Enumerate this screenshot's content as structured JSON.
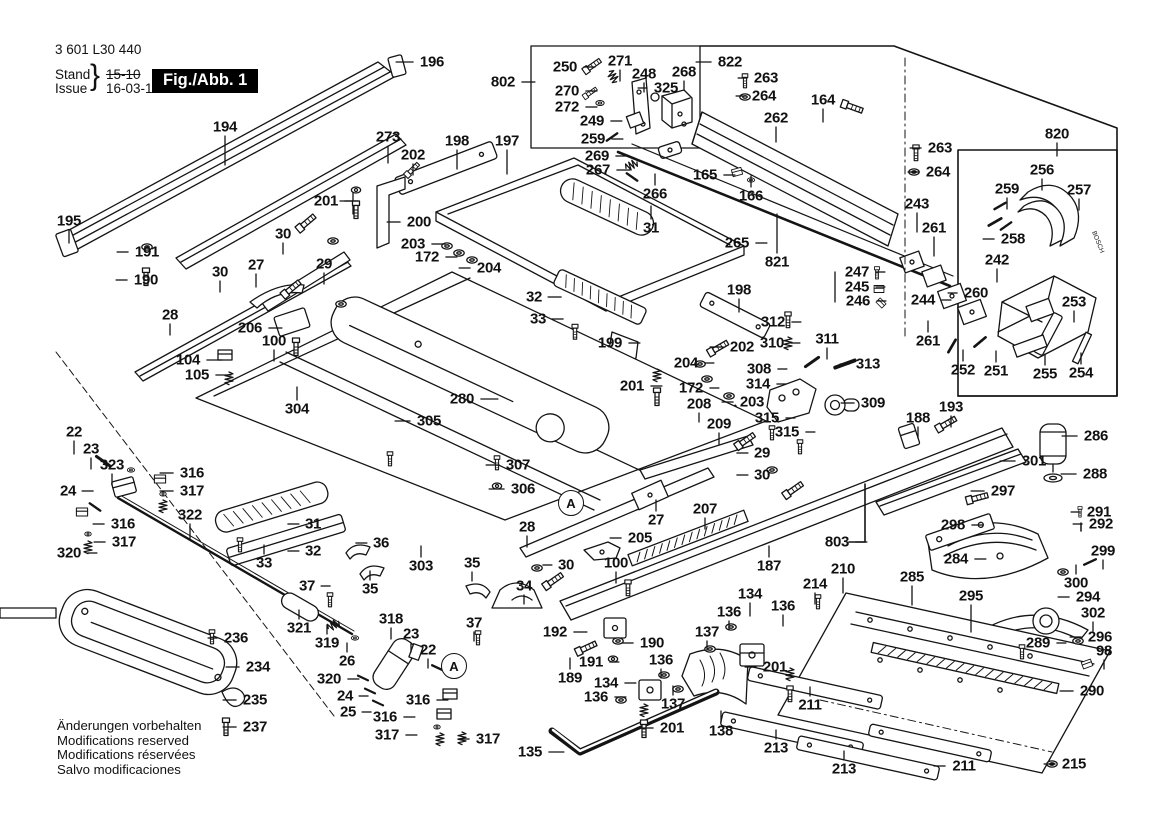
{
  "header": {
    "part_number": "3 601 L30 440",
    "stand_label": "Stand",
    "issue_label": "Issue",
    "brace": "}",
    "old_date": "15-10",
    "new_date": "16-03-10",
    "fig_label": "Fig./Abb. 1"
  },
  "footer": {
    "lines": [
      "Änderungen vorbehalten",
      "Modifications reserved",
      "Modifications réservées",
      "Salvo modificaciones"
    ]
  },
  "brand_text": "BOSCH",
  "colors": {
    "ink": "#141414",
    "badge_bg": "#000000",
    "badge_text": "#ffffff",
    "bg": "#ffffff"
  },
  "circled_refs": [
    {
      "label": "A",
      "x": 571,
      "y": 503
    },
    {
      "label": "A",
      "x": 454,
      "y": 666
    }
  ],
  "part_labels": [
    {
      "t": "194",
      "x": 225,
      "y": 127,
      "d": "d",
      "len": 30
    },
    {
      "t": "273",
      "x": 388,
      "y": 137,
      "d": "d",
      "len": 18
    },
    {
      "t": "196",
      "x": 432,
      "y": 62,
      "d": "l",
      "len": 18
    },
    {
      "t": "202",
      "x": 413,
      "y": 155,
      "d": "d",
      "len": 12
    },
    {
      "t": "198",
      "x": 457,
      "y": 141,
      "d": "d",
      "len": 20
    },
    {
      "t": "197",
      "x": 507,
      "y": 141,
      "d": "d",
      "len": 25
    },
    {
      "t": "201",
      "x": 326,
      "y": 201,
      "d": "r",
      "len": 14
    },
    {
      "t": "200",
      "x": 419,
      "y": 222,
      "d": "l",
      "len": 14
    },
    {
      "t": "30",
      "x": 283,
      "y": 234,
      "d": "d",
      "len": 12
    },
    {
      "t": "27",
      "x": 256,
      "y": 265,
      "d": "d",
      "len": 14
    },
    {
      "t": "29",
      "x": 324,
      "y": 264,
      "d": "d",
      "len": 12
    },
    {
      "t": "203",
      "x": 413,
      "y": 244,
      "d": "r",
      "len": 14
    },
    {
      "t": "172",
      "x": 427,
      "y": 257,
      "d": "r",
      "len": 12
    },
    {
      "t": "204",
      "x": 489,
      "y": 268,
      "d": "l",
      "len": 12
    },
    {
      "t": "195",
      "x": 69,
      "y": 221,
      "d": "d",
      "len": 14
    },
    {
      "t": "191",
      "x": 147,
      "y": 252,
      "d": "l",
      "len": 12
    },
    {
      "t": "190",
      "x": 146,
      "y": 280,
      "d": "l",
      "len": 12
    },
    {
      "t": "30",
      "x": 220,
      "y": 272,
      "d": "d",
      "len": 12
    },
    {
      "t": "28",
      "x": 170,
      "y": 315,
      "d": "d",
      "len": 12
    },
    {
      "t": "206",
      "x": 250,
      "y": 328,
      "d": "r",
      "len": 14
    },
    {
      "t": "100",
      "x": 274,
      "y": 341,
      "d": "d",
      "len": 12
    },
    {
      "t": "104",
      "x": 188,
      "y": 360,
      "d": "r",
      "len": 16
    },
    {
      "t": "105",
      "x": 197,
      "y": 375,
      "d": "r",
      "len": 16
    },
    {
      "t": "304",
      "x": 297,
      "y": 409,
      "d": "u",
      "len": 14
    },
    {
      "t": "305",
      "x": 429,
      "y": 421,
      "d": "l",
      "len": 16
    },
    {
      "t": "280",
      "x": 462,
      "y": 399,
      "d": "r",
      "len": 18
    },
    {
      "t": "32",
      "x": 534,
      "y": 297,
      "d": "r",
      "len": 14
    },
    {
      "t": "33",
      "x": 538,
      "y": 319,
      "d": "r",
      "len": 12
    },
    {
      "t": "31",
      "x": 651,
      "y": 228,
      "d": "u",
      "len": 14
    },
    {
      "t": "199",
      "x": 610,
      "y": 343,
      "d": "r",
      "len": 12
    },
    {
      "t": "198",
      "x": 739,
      "y": 290,
      "d": "d",
      "len": 14
    },
    {
      "t": "202",
      "x": 742,
      "y": 347,
      "d": "l",
      "len": 14
    },
    {
      "t": "204",
      "x": 686,
      "y": 363,
      "d": "r",
      "len": 10
    },
    {
      "t": "172",
      "x": 691,
      "y": 388,
      "d": "r",
      "len": 10
    },
    {
      "t": "203",
      "x": 752,
      "y": 402,
      "d": "l",
      "len": 12
    },
    {
      "t": "201",
      "x": 632,
      "y": 386,
      "d": "r",
      "len": 12
    },
    {
      "t": "208",
      "x": 699,
      "y": 404,
      "d": "d",
      "len": 10
    },
    {
      "t": "209",
      "x": 719,
      "y": 424,
      "d": "d",
      "len": 12
    },
    {
      "t": "307",
      "x": 518,
      "y": 465,
      "d": "l",
      "len": 14
    },
    {
      "t": "306",
      "x": 523,
      "y": 489,
      "d": "l",
      "len": 16
    },
    {
      "t": "265",
      "x": 737,
      "y": 243,
      "d": "r",
      "len": 12
    },
    {
      "t": "821",
      "x": 777,
      "y": 262,
      "d": "u",
      "len": 40
    },
    {
      "t": "266",
      "x": 655,
      "y": 194,
      "d": "u",
      "len": 12
    },
    {
      "t": "267",
      "x": 598,
      "y": 170,
      "d": "r",
      "len": 14
    },
    {
      "t": "269",
      "x": 597,
      "y": 156,
      "d": "r",
      "len": 14
    },
    {
      "t": "259",
      "x": 593,
      "y": 139,
      "d": "r",
      "len": 12
    },
    {
      "t": "249",
      "x": 592,
      "y": 121,
      "d": "r",
      "len": 12
    },
    {
      "t": "272",
      "x": 567,
      "y": 107,
      "d": "r",
      "len": 12
    },
    {
      "t": "270",
      "x": 567,
      "y": 91,
      "d": "r",
      "len": 12
    },
    {
      "t": "250",
      "x": 565,
      "y": 67,
      "d": "r",
      "len": 12
    },
    {
      "t": "271",
      "x": 620,
      "y": 61,
      "d": "d",
      "len": 12
    },
    {
      "t": "248",
      "x": 644,
      "y": 74,
      "d": "d",
      "len": 10
    },
    {
      "t": "268",
      "x": 684,
      "y": 72,
      "d": "d",
      "len": 10
    },
    {
      "t": "325",
      "x": 666,
      "y": 88,
      "d": "l",
      "len": 10
    },
    {
      "t": "802",
      "x": 503,
      "y": 82,
      "d": "r",
      "len": 14
    },
    {
      "t": "822",
      "x": 730,
      "y": 62,
      "d": "l",
      "len": 16
    },
    {
      "t": "263",
      "x": 766,
      "y": 78,
      "d": "l",
      "len": 10
    },
    {
      "t": "264",
      "x": 764,
      "y": 96,
      "d": "l",
      "len": 10
    },
    {
      "t": "164",
      "x": 823,
      "y": 100,
      "d": "d",
      "len": 14
    },
    {
      "t": "262",
      "x": 776,
      "y": 118,
      "d": "d",
      "len": 16
    },
    {
      "t": "165",
      "x": 705,
      "y": 175,
      "d": "r",
      "len": 12
    },
    {
      "t": "166",
      "x": 751,
      "y": 196,
      "d": "u",
      "len": 12
    },
    {
      "t": "263",
      "x": 940,
      "y": 148,
      "d": "l",
      "len": 12
    },
    {
      "t": "264",
      "x": 938,
      "y": 172,
      "d": "l",
      "len": 12
    },
    {
      "t": "243",
      "x": 917,
      "y": 204,
      "d": "d",
      "len": 20
    },
    {
      "t": "261",
      "x": 934,
      "y": 228,
      "d": "d",
      "len": 20
    },
    {
      "t": "820",
      "x": 1057,
      "y": 134,
      "d": "d",
      "len": 14
    },
    {
      "t": "256",
      "x": 1042,
      "y": 170,
      "d": "d",
      "len": 12
    },
    {
      "t": "259",
      "x": 1007,
      "y": 189,
      "d": "d",
      "len": 12
    },
    {
      "t": "257",
      "x": 1079,
      "y": 190,
      "d": "d",
      "len": 12
    },
    {
      "t": "258",
      "x": 1013,
      "y": 239,
      "d": "l",
      "len": 12
    },
    {
      "t": "242",
      "x": 997,
      "y": 260,
      "d": "d",
      "len": 14
    },
    {
      "t": "247",
      "x": 857,
      "y": 272,
      "d": "r",
      "len": 10
    },
    {
      "t": "245",
      "x": 857,
      "y": 287,
      "d": "r",
      "len": 10
    },
    {
      "t": "246",
      "x": 858,
      "y": 301,
      "d": "r",
      "len": 10
    },
    {
      "t": "244",
      "x": 923,
      "y": 300,
      "d": "r",
      "len": 10
    },
    {
      "t": "260",
      "x": 976,
      "y": 293,
      "d": "l",
      "len": 10
    },
    {
      "t": "253",
      "x": 1074,
      "y": 302,
      "d": "d",
      "len": 12
    },
    {
      "t": "261",
      "x": 928,
      "y": 341,
      "d": "u",
      "len": 12
    },
    {
      "t": "252",
      "x": 963,
      "y": 370,
      "d": "u",
      "len": 12
    },
    {
      "t": "251",
      "x": 996,
      "y": 371,
      "d": "u",
      "len": 12
    },
    {
      "t": "255",
      "x": 1045,
      "y": 374,
      "d": "u",
      "len": 12
    },
    {
      "t": "254",
      "x": 1081,
      "y": 373,
      "d": "u",
      "len": 12
    },
    {
      "t": "312",
      "x": 773,
      "y": 322,
      "d": "r",
      "len": 10
    },
    {
      "t": "310",
      "x": 772,
      "y": 343,
      "d": "r",
      "len": 10
    },
    {
      "t": "311",
      "x": 827,
      "y": 339,
      "d": "d",
      "len": 12
    },
    {
      "t": "308",
      "x": 759,
      "y": 369,
      "d": "r",
      "len": 10
    },
    {
      "t": "313",
      "x": 868,
      "y": 364,
      "d": "l",
      "len": 10
    },
    {
      "t": "314",
      "x": 758,
      "y": 384,
      "d": "r",
      "len": 10
    },
    {
      "t": "309",
      "x": 873,
      "y": 403,
      "d": "l",
      "len": 14
    },
    {
      "t": "315",
      "x": 767,
      "y": 418,
      "d": "r",
      "len": 10
    },
    {
      "t": "315",
      "x": 787,
      "y": 432,
      "d": "r",
      "len": 10
    },
    {
      "t": "188",
      "x": 918,
      "y": 418,
      "d": "d",
      "len": 12
    },
    {
      "t": "193",
      "x": 951,
      "y": 407,
      "d": "d",
      "len": 12
    },
    {
      "t": "29",
      "x": 762,
      "y": 453,
      "d": "l",
      "len": 12
    },
    {
      "t": "30",
      "x": 762,
      "y": 475,
      "d": "l",
      "len": 12
    },
    {
      "t": "301",
      "x": 1034,
      "y": 461,
      "d": "l",
      "len": 16
    },
    {
      "t": "286",
      "x": 1096,
      "y": 436,
      "d": "l",
      "len": 16
    },
    {
      "t": "288",
      "x": 1095,
      "y": 474,
      "d": "l",
      "len": 16
    },
    {
      "t": "297",
      "x": 1003,
      "y": 491,
      "d": "l",
      "len": 14
    },
    {
      "t": "298",
      "x": 953,
      "y": 525,
      "d": "r",
      "len": 12
    },
    {
      "t": "291",
      "x": 1099,
      "y": 512,
      "d": "l",
      "len": 10
    },
    {
      "t": "292",
      "x": 1101,
      "y": 524,
      "d": "l",
      "len": 10
    },
    {
      "t": "284",
      "x": 956,
      "y": 559,
      "d": "r",
      "len": 12
    },
    {
      "t": "299",
      "x": 1103,
      "y": 551,
      "d": "d",
      "len": 10
    },
    {
      "t": "300",
      "x": 1076,
      "y": 583,
      "d": "u",
      "len": 10
    },
    {
      "t": "294",
      "x": 1088,
      "y": 597,
      "d": "l",
      "len": 12
    },
    {
      "t": "302",
      "x": 1093,
      "y": 613,
      "d": "d",
      "len": 10
    },
    {
      "t": "296",
      "x": 1100,
      "y": 637,
      "d": "l",
      "len": 12
    },
    {
      "t": "98",
      "x": 1104,
      "y": 651,
      "d": "d",
      "len": 10
    },
    {
      "t": "289",
      "x": 1038,
      "y": 643,
      "d": "r",
      "len": 10
    },
    {
      "t": "290",
      "x": 1092,
      "y": 691,
      "d": "l",
      "len": 14
    },
    {
      "t": "295",
      "x": 971,
      "y": 596,
      "d": "d",
      "len": 28
    },
    {
      "t": "285",
      "x": 912,
      "y": 577,
      "d": "d",
      "len": 20
    },
    {
      "t": "803",
      "x": 837,
      "y": 542,
      "d": "r",
      "len": 12
    },
    {
      "t": "210",
      "x": 843,
      "y": 569,
      "d": "d",
      "len": 16
    },
    {
      "t": "214",
      "x": 815,
      "y": 584,
      "d": "d",
      "len": 12
    },
    {
      "t": "22",
      "x": 74,
      "y": 432,
      "d": "d",
      "len": 14
    },
    {
      "t": "23",
      "x": 91,
      "y": 449,
      "d": "d",
      "len": 12
    },
    {
      "t": "323",
      "x": 112,
      "y": 465,
      "d": "d",
      "len": 12
    },
    {
      "t": "24",
      "x": 68,
      "y": 491,
      "d": "r",
      "len": 12
    },
    {
      "t": "316",
      "x": 192,
      "y": 473,
      "d": "l",
      "len": 14
    },
    {
      "t": "317",
      "x": 192,
      "y": 491,
      "d": "l",
      "len": 14
    },
    {
      "t": "316",
      "x": 123,
      "y": 524,
      "d": "l",
      "len": 12
    },
    {
      "t": "317",
      "x": 124,
      "y": 542,
      "d": "l",
      "len": 12
    },
    {
      "t": "320",
      "x": 69,
      "y": 553,
      "d": "r",
      "len": 10
    },
    {
      "t": "322",
      "x": 190,
      "y": 515,
      "d": "d",
      "len": 16
    },
    {
      "t": "31",
      "x": 313,
      "y": 524,
      "d": "l",
      "len": 12
    },
    {
      "t": "32",
      "x": 313,
      "y": 551,
      "d": "l",
      "len": 12
    },
    {
      "t": "33",
      "x": 264,
      "y": 563,
      "d": "u",
      "len": 10
    },
    {
      "t": "36",
      "x": 381,
      "y": 543,
      "d": "l",
      "len": 12
    },
    {
      "t": "35",
      "x": 370,
      "y": 589,
      "d": "u",
      "len": 10
    },
    {
      "t": "37",
      "x": 307,
      "y": 586,
      "d": "r",
      "len": 10
    },
    {
      "t": "303",
      "x": 421,
      "y": 566,
      "d": "u",
      "len": 12
    },
    {
      "t": "35",
      "x": 472,
      "y": 563,
      "d": "d",
      "len": 10
    },
    {
      "t": "34",
      "x": 524,
      "y": 586,
      "d": "d",
      "len": 10
    },
    {
      "t": "37",
      "x": 474,
      "y": 623,
      "d": "d",
      "len": 10
    },
    {
      "t": "30",
      "x": 566,
      "y": 565,
      "d": "l",
      "len": 10
    },
    {
      "t": "100",
      "x": 616,
      "y": 563,
      "d": "d",
      "len": 12
    },
    {
      "t": "205",
      "x": 640,
      "y": 538,
      "d": "l",
      "len": 12
    },
    {
      "t": "27",
      "x": 656,
      "y": 520,
      "d": "u",
      "len": 12
    },
    {
      "t": "28",
      "x": 527,
      "y": 527,
      "d": "d",
      "len": 12
    },
    {
      "t": "207",
      "x": 705,
      "y": 509,
      "d": "d",
      "len": 12
    },
    {
      "t": "187",
      "x": 769,
      "y": 566,
      "d": "u",
      "len": 12
    },
    {
      "t": "192",
      "x": 555,
      "y": 632,
      "d": "r",
      "len": 14
    },
    {
      "t": "190",
      "x": 652,
      "y": 643,
      "d": "l",
      "len": 12
    },
    {
      "t": "191",
      "x": 591,
      "y": 662,
      "d": "r",
      "len": 10
    },
    {
      "t": "189",
      "x": 570,
      "y": 678,
      "d": "u",
      "len": 12
    },
    {
      "t": "134",
      "x": 606,
      "y": 683,
      "d": "r",
      "len": 12
    },
    {
      "t": "136",
      "x": 596,
      "y": 697,
      "d": "r",
      "len": 12
    },
    {
      "t": "136",
      "x": 661,
      "y": 660,
      "d": "d",
      "len": 10
    },
    {
      "t": "137",
      "x": 673,
      "y": 704,
      "d": "u",
      "len": 10
    },
    {
      "t": "136",
      "x": 729,
      "y": 612,
      "d": "d",
      "len": 10
    },
    {
      "t": "137",
      "x": 707,
      "y": 632,
      "d": "d",
      "len": 10
    },
    {
      "t": "134",
      "x": 750,
      "y": 594,
      "d": "d",
      "len": 14
    },
    {
      "t": "136",
      "x": 783,
      "y": 606,
      "d": "d",
      "len": 12
    },
    {
      "t": "201",
      "x": 775,
      "y": 667,
      "d": "l",
      "len": 12
    },
    {
      "t": "201",
      "x": 672,
      "y": 728,
      "d": "l",
      "len": 12
    },
    {
      "t": "135",
      "x": 530,
      "y": 752,
      "d": "r",
      "len": 16
    },
    {
      "t": "138",
      "x": 721,
      "y": 731,
      "d": "u",
      "len": 12
    },
    {
      "t": "318",
      "x": 391,
      "y": 619,
      "d": "d",
      "len": 12
    },
    {
      "t": "23",
      "x": 411,
      "y": 634,
      "d": "d",
      "len": 10
    },
    {
      "t": "22",
      "x": 428,
      "y": 650,
      "d": "d",
      "len": 10
    },
    {
      "t": "316",
      "x": 418,
      "y": 700,
      "d": "r",
      "len": 12
    },
    {
      "t": "316",
      "x": 385,
      "y": 717,
      "d": "r",
      "len": 12
    },
    {
      "t": "317",
      "x": 387,
      "y": 735,
      "d": "r",
      "len": 12
    },
    {
      "t": "317",
      "x": 488,
      "y": 739,
      "d": "l",
      "len": 12
    },
    {
      "t": "320",
      "x": 329,
      "y": 679,
      "d": "r",
      "len": 12
    },
    {
      "t": "24",
      "x": 345,
      "y": 696,
      "d": "r",
      "len": 10
    },
    {
      "t": "25",
      "x": 348,
      "y": 712,
      "d": "r",
      "len": 10
    },
    {
      "t": "26",
      "x": 347,
      "y": 661,
      "d": "u",
      "len": 10
    },
    {
      "t": "319",
      "x": 327,
      "y": 643,
      "d": "u",
      "len": 10
    },
    {
      "t": "321",
      "x": 299,
      "y": 628,
      "d": "u",
      "len": 10
    },
    {
      "t": "236",
      "x": 236,
      "y": 638,
      "d": "l",
      "len": 10
    },
    {
      "t": "234",
      "x": 258,
      "y": 667,
      "d": "l",
      "len": 14
    },
    {
      "t": "235",
      "x": 255,
      "y": 700,
      "d": "l",
      "len": 14
    },
    {
      "t": "237",
      "x": 255,
      "y": 727,
      "d": "l",
      "len": 14
    },
    {
      "t": "213",
      "x": 776,
      "y": 748,
      "d": "u",
      "len": 10
    },
    {
      "t": "213",
      "x": 844,
      "y": 769,
      "d": "u",
      "len": 10
    },
    {
      "t": "211",
      "x": 810,
      "y": 705,
      "d": "u",
      "len": 10
    },
    {
      "t": "211",
      "x": 964,
      "y": 766,
      "d": "l",
      "len": 12
    },
    {
      "t": "215",
      "x": 1074,
      "y": 764,
      "d": "l",
      "len": 12
    }
  ]
}
